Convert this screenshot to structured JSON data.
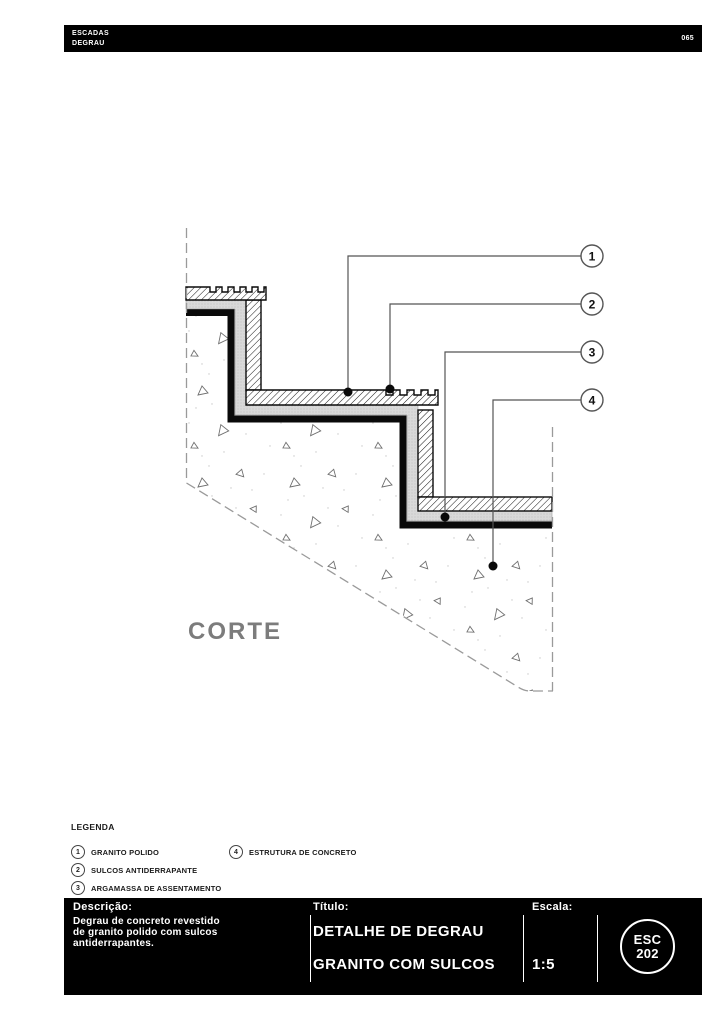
{
  "header": {
    "line1": "ESCADAS",
    "line2": "DEGRAU",
    "page_number": "065"
  },
  "drawing": {
    "section_label": "CORTE",
    "callouts": [
      {
        "number": "1"
      },
      {
        "number": "2"
      },
      {
        "number": "3"
      },
      {
        "number": "4"
      }
    ]
  },
  "legend": {
    "title": "LEGENDA",
    "items": [
      {
        "number": "1",
        "label": "GRANITO POLIDO"
      },
      {
        "number": "2",
        "label": "SULCOS ANTIDERRAPANTE"
      },
      {
        "number": "3",
        "label": "ARGAMASSA DE ASSENTAMENTO"
      },
      {
        "number": "4",
        "label": "ESTRUTURA DE CONCRETO"
      }
    ]
  },
  "title_block": {
    "description_label": "Descrição:",
    "description_lines": [
      "Degrau de concreto revestido",
      "de granito polido com sulcos",
      "antiderrapantes."
    ],
    "title_label": "Título:",
    "title_line1": "DETALHE DE DEGRAU",
    "title_line2": "GRANITO COM SULCOS",
    "scale_label": "Escala:",
    "scale_value": "1:5",
    "sheet_code": {
      "line1": "ESC",
      "line2": "202"
    }
  },
  "colors": {
    "header_bg": "#000000",
    "title_block_bg": "#000000",
    "text_on_dark": "#ffffff",
    "mortar_gray": "#d9d9d9",
    "line_black": "#111111",
    "dash_gray": "#9a9a9a",
    "section_label_gray": "#7c7c7c"
  }
}
